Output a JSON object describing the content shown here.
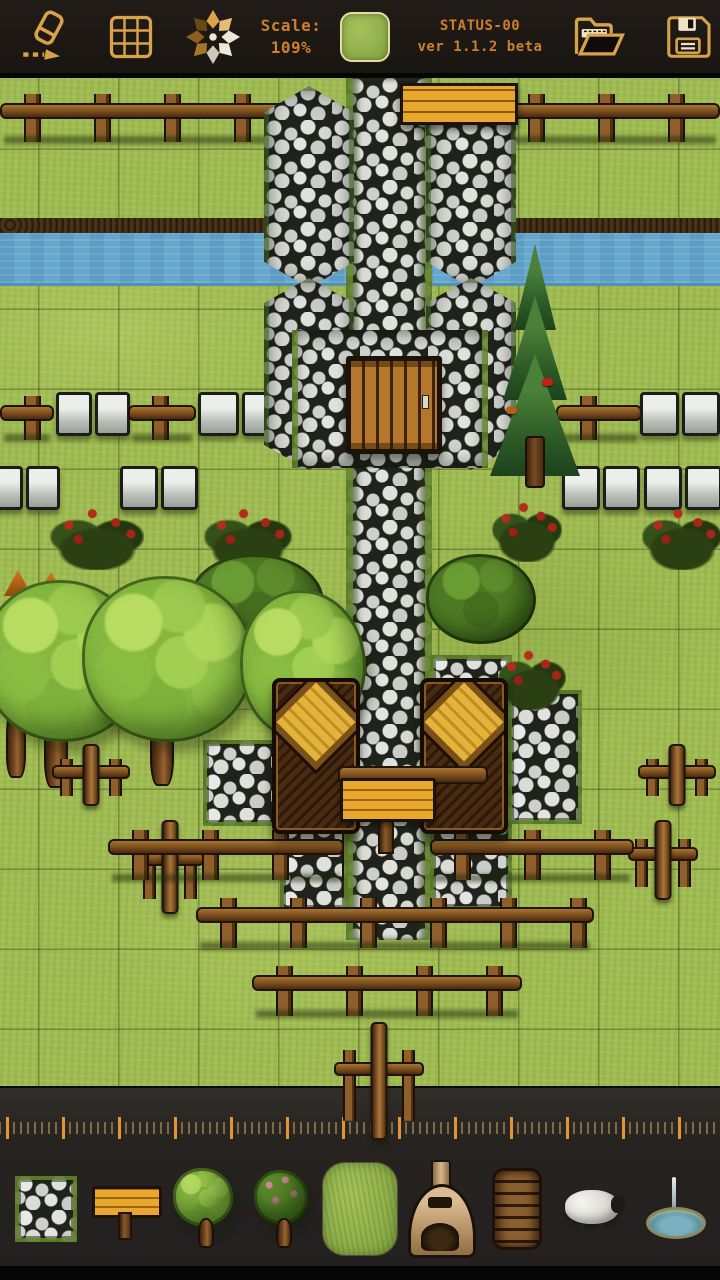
{
  "toolbar": {
    "scale_label": "Scale:",
    "scale_value": "109%",
    "status_line1": "STATUS-00",
    "status_line2": "ver 1.1.2 beta",
    "text_color": "#cd7f2f",
    "icon_color": "#d9a24a",
    "background": "#1b1713",
    "icons": [
      "eraser-icon",
      "grid-icon",
      "pan-star-icon",
      "current-tile-preview",
      "open-folder-icon",
      "save-icon"
    ]
  },
  "canvas": {
    "scale_percent": 109,
    "tile_size_px": 80,
    "terrain": "grass",
    "features": [
      "river",
      "cobblestone-road",
      "stone-towers",
      "castle-wall",
      "wooden-door",
      "wooden-platform",
      "wooden-fences",
      "stone-block-walls",
      "rose-bushes",
      "deciduous-trees",
      "pine-tree-with-birds",
      "market-stalls",
      "wooden-sign",
      "cross-barricades",
      "mushrooms"
    ],
    "colors": {
      "grass": "#9fbb53",
      "water": "#66a7ce",
      "river_bank": "#3b2a14",
      "stone": "#d8dad6",
      "wood": "#8a5a2a",
      "accent_orange": "#e8a62a"
    }
  },
  "ruler": {
    "major_tick_color": "#d98a2e",
    "minor_tick_color": "#6b5c42"
  },
  "palette": {
    "selected_index": 4,
    "items": [
      {
        "name": "stone-path-tile"
      },
      {
        "name": "wooden-sign"
      },
      {
        "name": "tree"
      },
      {
        "name": "fruit-tree"
      },
      {
        "name": "grass-tile"
      },
      {
        "name": "furnace"
      },
      {
        "name": "log-stack"
      },
      {
        "name": "sheep"
      },
      {
        "name": "fountain"
      }
    ]
  }
}
